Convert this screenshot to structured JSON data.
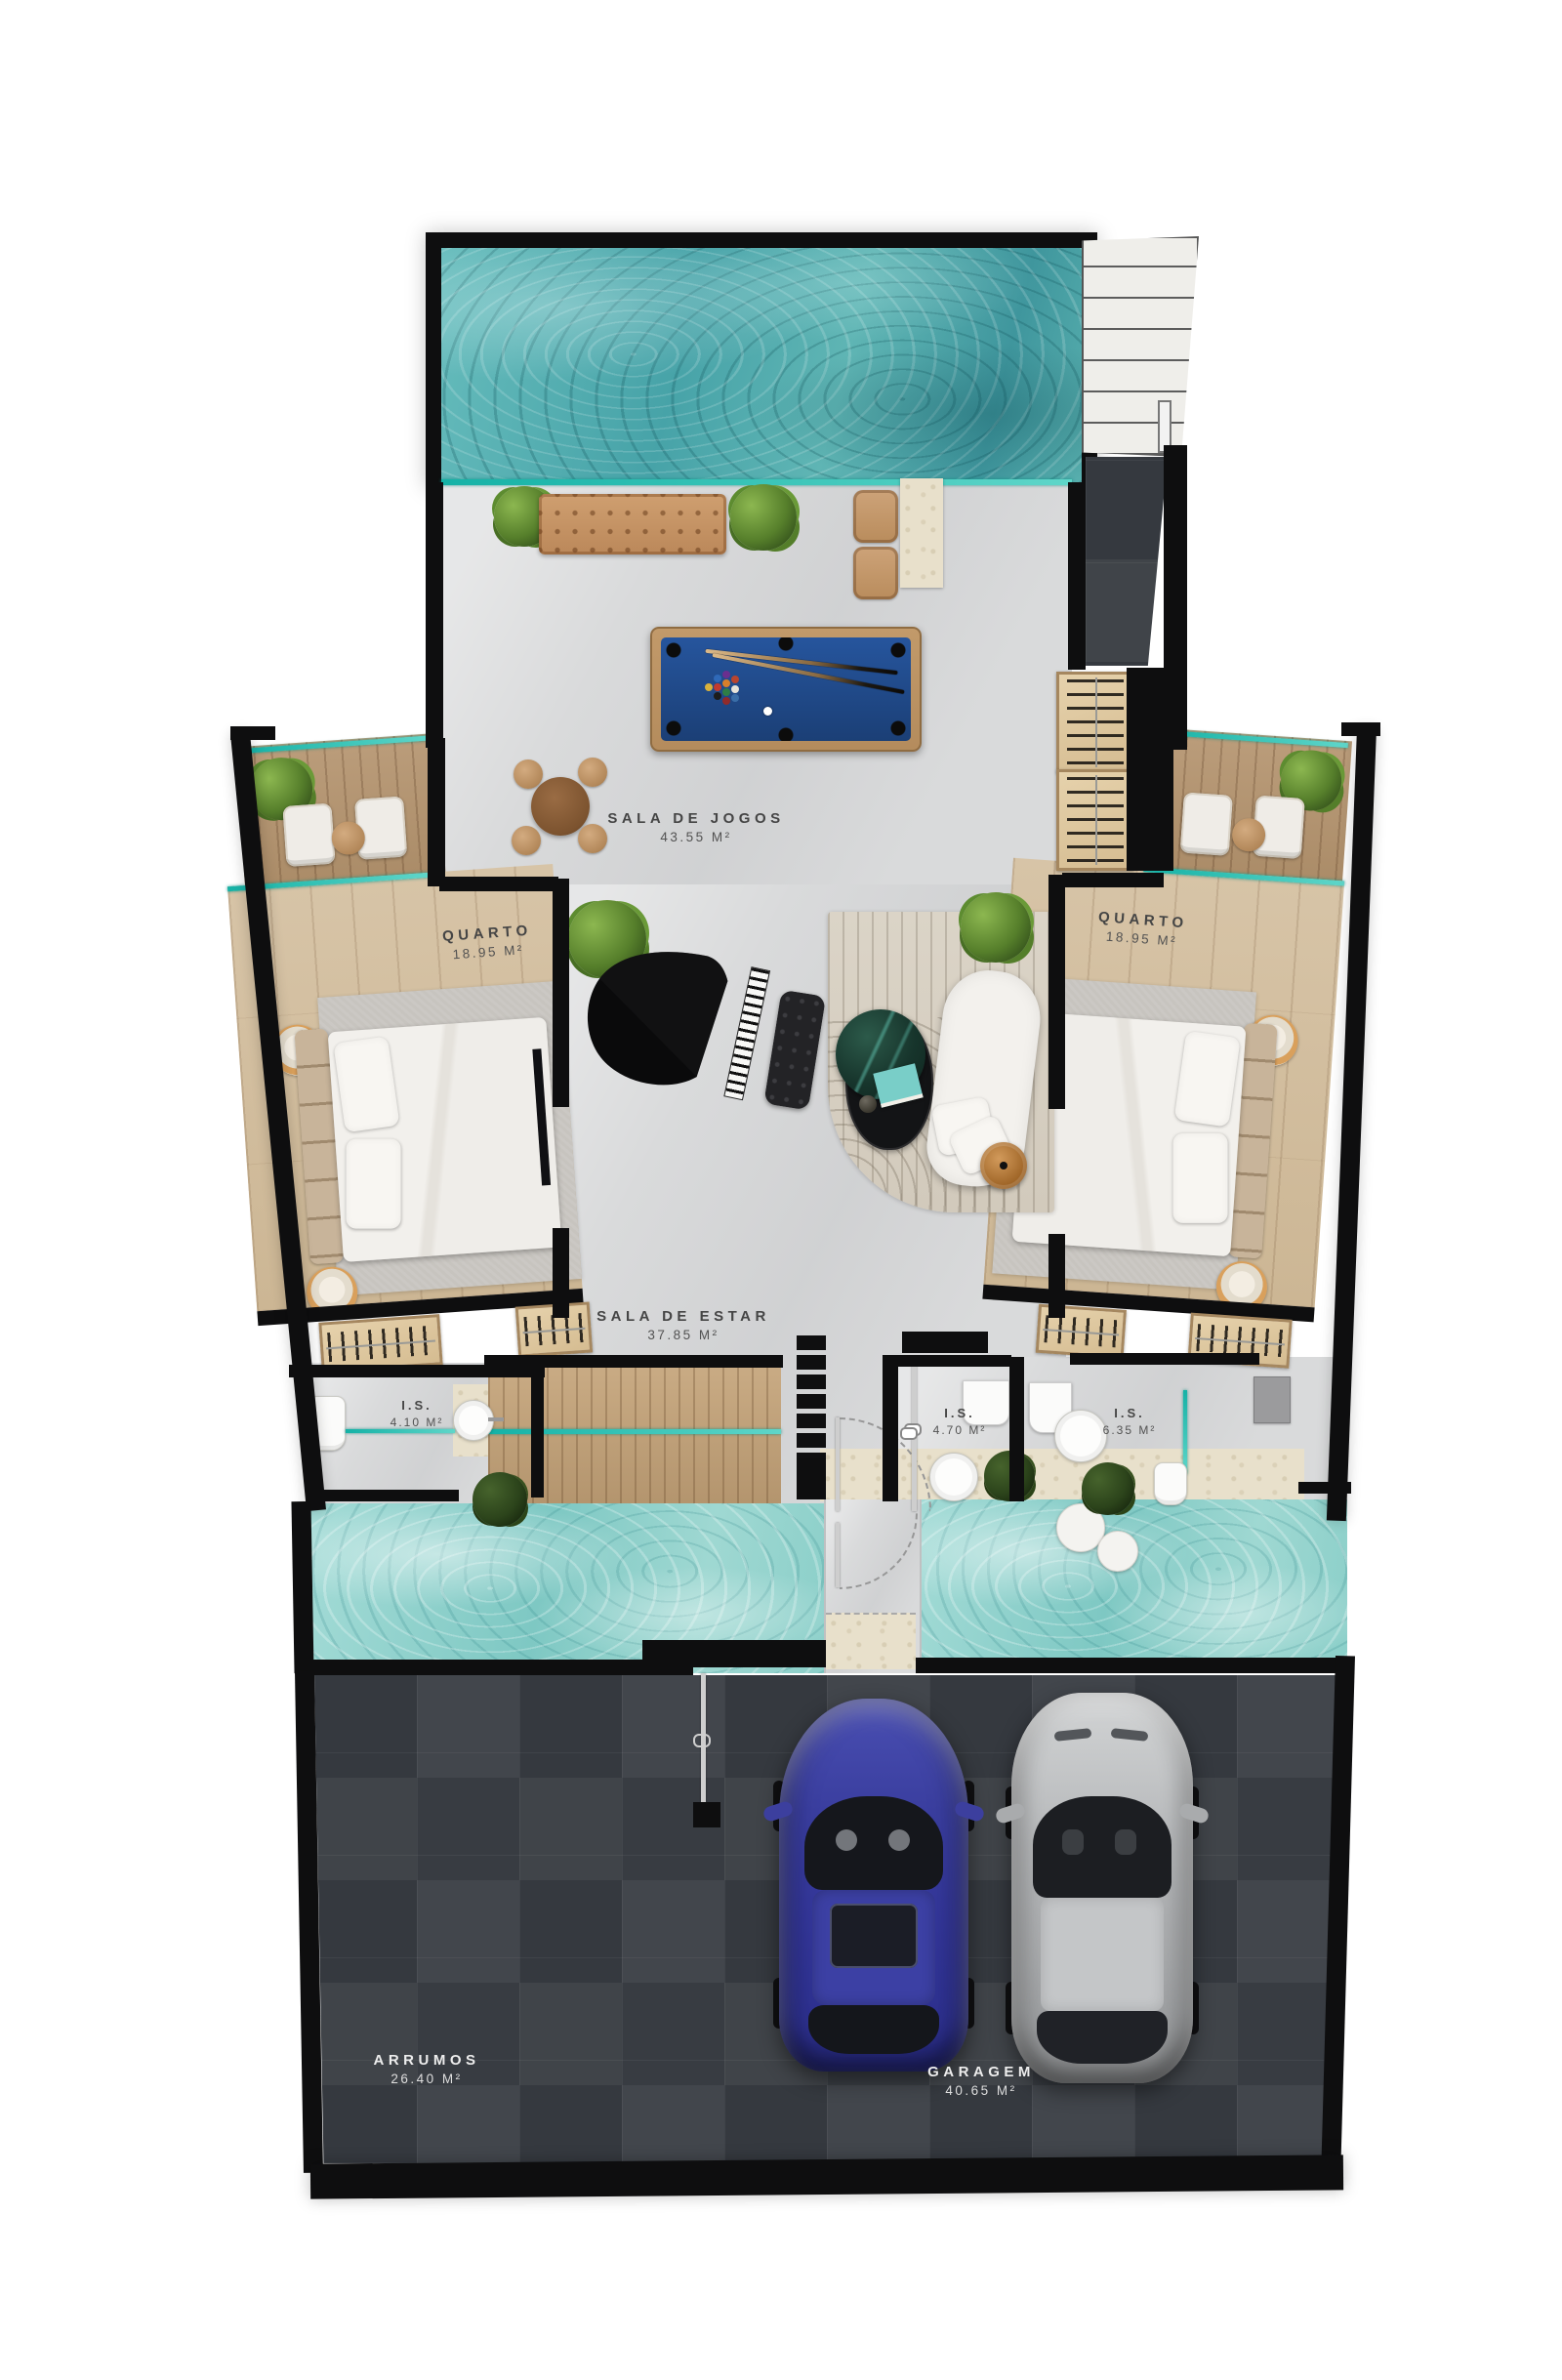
{
  "palette": {
    "wall": "#0e0e0f",
    "floor_stone": "#d9dadb",
    "wood_floor": "#d2bf9f",
    "deck_wood": "#b3946d",
    "slate_tile": "#3c4046",
    "water_deep": "#4fa8ab",
    "water_light": "#8fd0ca",
    "glass_teal": "#15b2a6",
    "bench_tan": "#c89a6e",
    "pool_felt_blue": "#1f4b8e",
    "car_blue": "#383c9c",
    "car_silver": "#b3b5b7"
  },
  "rooms": [
    {
      "id": "sala-de-jogos",
      "name": "SALA DE JOGOS",
      "area": "43.55 M²"
    },
    {
      "id": "quarto-esquerdo",
      "name": "QUARTO",
      "area": "18.95 M²"
    },
    {
      "id": "quarto-direito",
      "name": "QUARTO",
      "area": "18.95 M²"
    },
    {
      "id": "sala-de-estar",
      "name": "SALA DE ESTAR",
      "area": "37.85 M²"
    },
    {
      "id": "is-esquerda",
      "name": "I.S.",
      "area": "4.10 M²"
    },
    {
      "id": "is-centro",
      "name": "I.S.",
      "area": "4.70 M²"
    },
    {
      "id": "is-direita",
      "name": "I.S.",
      "area": "6.35 M²"
    },
    {
      "id": "arrumos",
      "name": "ARRUMOS",
      "area": "26.40 M²"
    },
    {
      "id": "garagem",
      "name": "GARAGEM",
      "area": "40.65 M²"
    }
  ]
}
